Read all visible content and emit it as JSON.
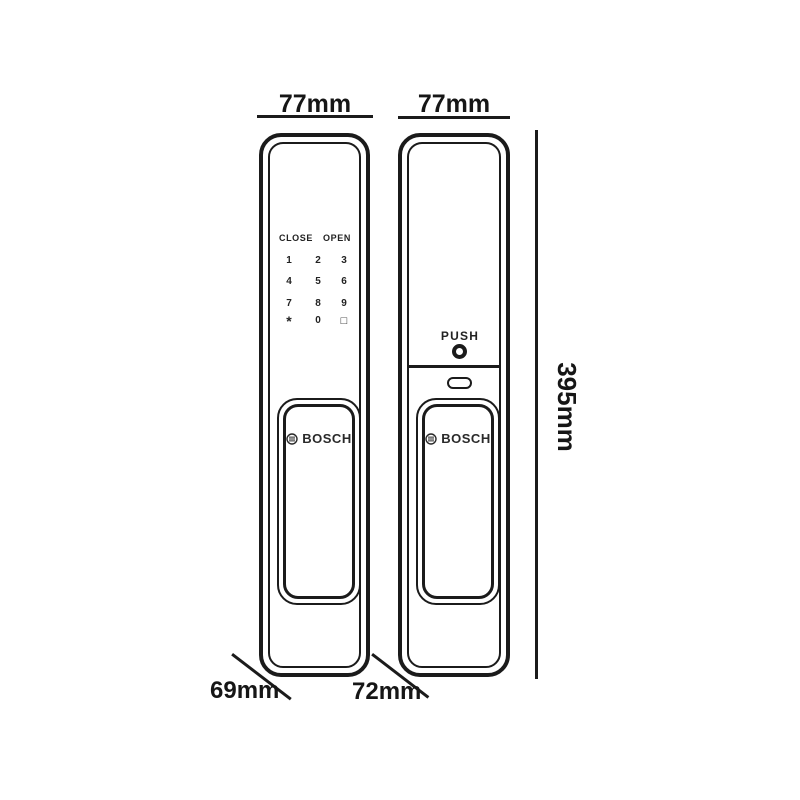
{
  "colors": {
    "ink": "#1b1b1b",
    "background": "#ffffff",
    "logo_gray": "#2a2a2a"
  },
  "dimensions": {
    "front_width": "77mm",
    "back_width": "77mm",
    "height": "395mm",
    "front_depth": "69mm",
    "back_depth": "72mm"
  },
  "front_panel": {
    "keypad": {
      "close_label": "CLOSE",
      "open_label": "OPEN",
      "keys": [
        "1",
        "2",
        "3",
        "4",
        "5",
        "6",
        "7",
        "8",
        "9",
        "*",
        "0",
        "□"
      ]
    },
    "brand": "BOSCH"
  },
  "back_panel": {
    "push_label": "PUSH",
    "brand": "BOSCH"
  }
}
